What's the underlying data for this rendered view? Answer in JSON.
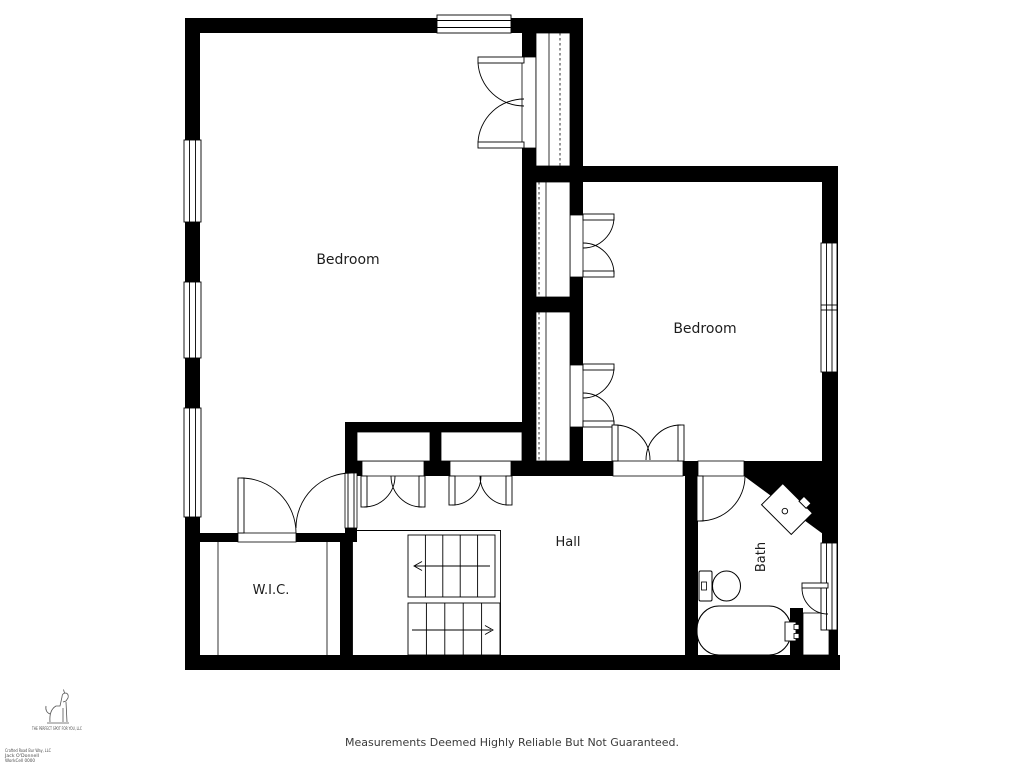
{
  "plan": {
    "rooms": [
      {
        "id": "bedroom-left",
        "label": "Bedroom"
      },
      {
        "id": "bedroom-right",
        "label": "Bedroom"
      },
      {
        "id": "hall",
        "label": "Hall"
      },
      {
        "id": "wic",
        "label": "W.I.C."
      },
      {
        "id": "bath",
        "label": "Bath"
      }
    ],
    "features": [
      "stairs-up-down",
      "closets-with-rods",
      "windows",
      "bathtub",
      "toilet",
      "corner-vanity"
    ]
  },
  "footer": {
    "disclaimer": "Measurements Deemed Highly Reliable But Not Guaranteed."
  },
  "branding": {
    "company": "THE PERFECT SPOT FOR YOU, LLC",
    "fine_print": [
      "Crafted Road Bur Way, LLC",
      "Jack O'Donnell",
      "WorkCell 0000"
    ]
  },
  "colors": {
    "wall": "#000000",
    "line": "#000000",
    "background": "#ffffff",
    "label": "#1d1d1d",
    "footer_text": "#3a3a3a"
  }
}
